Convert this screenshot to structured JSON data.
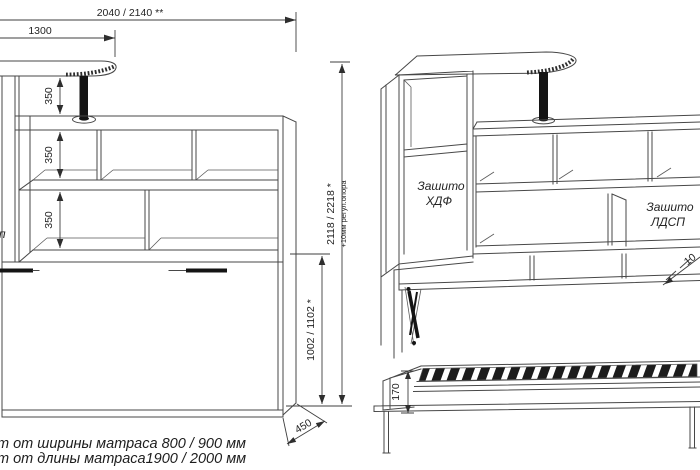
{
  "meta": {
    "background": "#ffffff",
    "line_color": "#474747",
    "text_color": "#242424",
    "fill_black": "#141414"
  },
  "front_view": {
    "dims": {
      "total_width": "2040 / 2140 **",
      "table_width": "1300",
      "shelf_gap": "350",
      "overall_height": "2118 / 2218 *",
      "overall_height_note": "+10мм регул.опора",
      "bed_section_height": "1002 / 1102 *",
      "side_depth": "450"
    },
    "edge_text_fragment": "п",
    "footnotes": [
      "т от ширины матраса 800 / 900 мм",
      "т от длины матраса1900 / 2000 мм"
    ]
  },
  "side_view": {
    "labels": {
      "hdf": [
        "Зашито",
        "ХДФ"
      ],
      "ldsp": [
        "Зашито",
        "ЛДСП"
      ]
    },
    "dims": {
      "frame_height": "170",
      "clipped_fragment": "10"
    }
  }
}
